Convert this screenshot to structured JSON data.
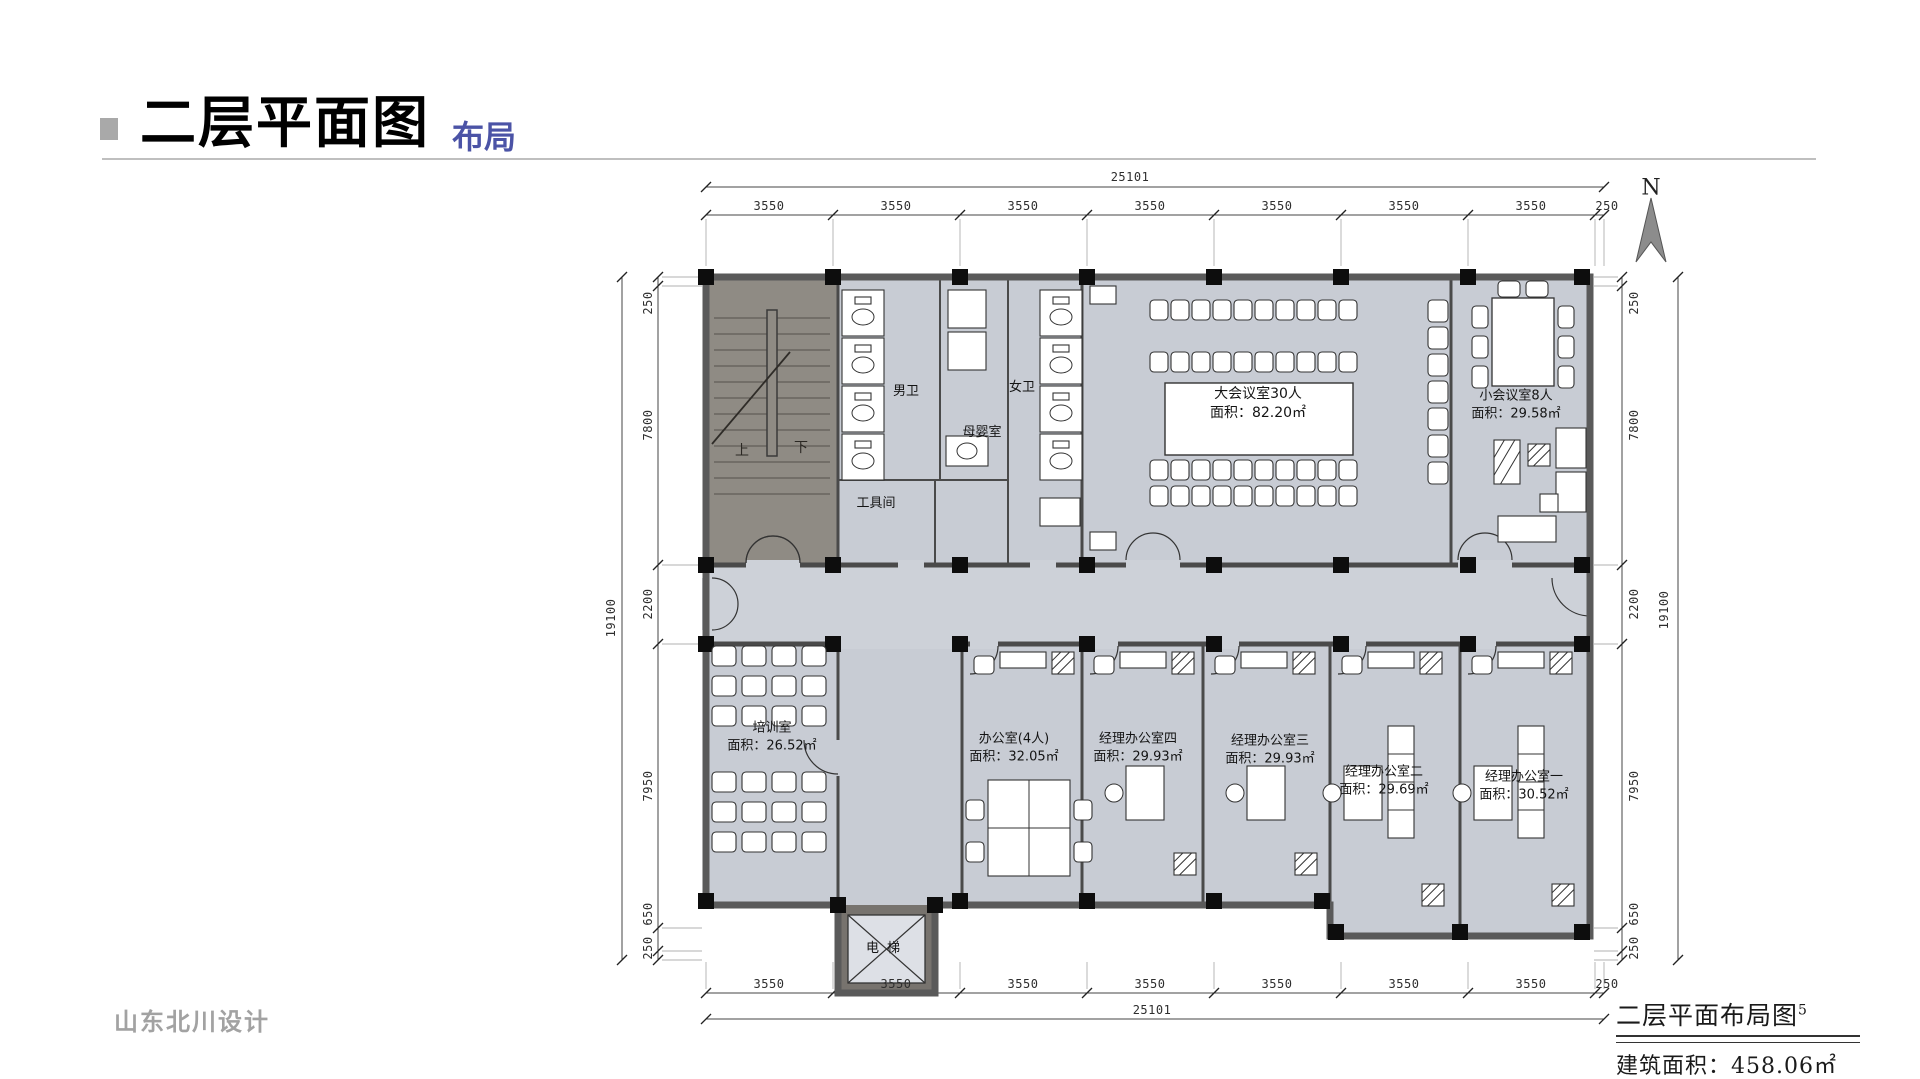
{
  "header": {
    "title": "二层平面图",
    "subtitle": "布局"
  },
  "company": "山东北川设计",
  "titleblock": {
    "drawing_title": "二层平面布局图",
    "sheet_no": "5",
    "area": "建筑面积：458.06㎡"
  },
  "north": {
    "label": "N"
  },
  "stair": {
    "up": "上",
    "down": "下"
  },
  "rooms": {
    "main_meeting": {
      "name": "大会议室30人",
      "area": "面积：82.20㎡"
    },
    "small_meeting": {
      "name": "小会议室8人",
      "area": "面积：29.58㎡"
    },
    "mens_wc": {
      "name": "男卫"
    },
    "womens_wc": {
      "name": "女卫"
    },
    "nursing": {
      "name": "母婴室"
    },
    "tool_room": {
      "name": "工具间"
    },
    "training": {
      "name": "培训室",
      "area": "面积：26.52㎡"
    },
    "office4": {
      "name": "办公室(4人)",
      "area": "面积：32.05㎡"
    },
    "manager4": {
      "name": "经理办公室四",
      "area": "面积：29.93㎡"
    },
    "manager3": {
      "name": "经理办公室三",
      "area": "面积：29.93㎡"
    },
    "manager2": {
      "name": "经理办公室二",
      "area": "面积：29.69㎡"
    },
    "manager1": {
      "name": "经理办公室一",
      "area": "面积：30.52㎡"
    },
    "elevator": {
      "name": "电梯"
    }
  },
  "dims": {
    "top": {
      "overall": "25101",
      "segments": [
        "3550",
        "3550",
        "3550",
        "3550",
        "3550",
        "3550",
        "3550"
      ],
      "end": "250"
    },
    "bottom": {
      "overall": "25101",
      "segments": [
        "3550",
        "3550",
        "3550",
        "3550",
        "3550",
        "3550",
        "3550"
      ],
      "end": "250"
    },
    "left": {
      "overall": "19100",
      "segments": [
        "250",
        "7800",
        "2200",
        "7950",
        "650",
        "250"
      ]
    },
    "right": {
      "overall": "19100",
      "segments": [
        "250",
        "7800",
        "2200",
        "7950",
        "650",
        "250"
      ]
    }
  }
}
